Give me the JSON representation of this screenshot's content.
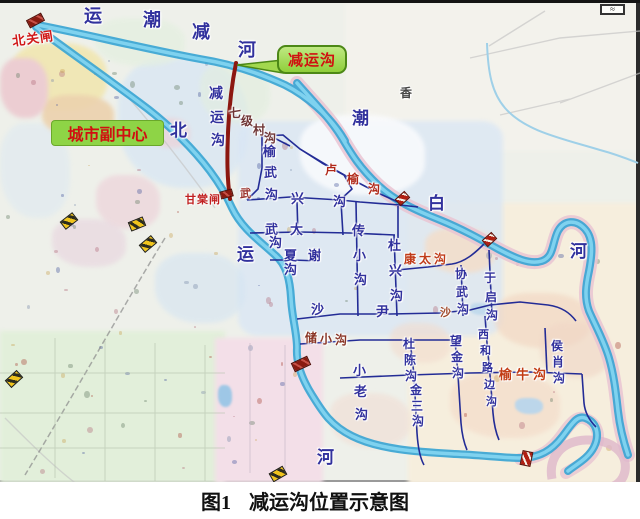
{
  "caption": {
    "figure": "图1",
    "title": "减运沟位置示意图"
  },
  "callout": {
    "text": "减运沟"
  },
  "city_subcenter": {
    "text": "城市副中心"
  },
  "colors": {
    "river_cyan": "#3ba6d4",
    "river_core": "#7fd2ef",
    "floodplain_pink": "#e9c4d2",
    "channel_dark_red": "#8c1710",
    "ditch_navy": "#232c96",
    "label_blue": "#31319d",
    "label_red": "#c03a18",
    "callout_green": "#8fce3a",
    "callout_text_red": "#d01010"
  },
  "map": {
    "stations": [
      {
        "name": "beiguanzha",
        "text": "北关闸",
        "x": 12,
        "y": 29,
        "size": 13,
        "color": "#d01818",
        "rot": -8
      },
      {
        "name": "gantangzha",
        "text": "甘棠闸",
        "x": 185,
        "y": 192,
        "size": 11,
        "color": "#c02020",
        "rot": 0
      }
    ],
    "labels": [
      {
        "name": "yunchaojian-river",
        "text": "运潮减河",
        "size": 18,
        "color": "#31319d",
        "chars": [
          {
            "c": "运",
            "x": 84,
            "y": 4
          },
          {
            "c": "潮",
            "x": 143,
            "y": 8
          },
          {
            "c": "减",
            "x": 192,
            "y": 20
          },
          {
            "c": "河",
            "x": 238,
            "y": 38
          }
        ]
      },
      {
        "name": "beiyun-river",
        "text": "北运河",
        "size": 17,
        "color": "#31319d",
        "chars": [
          {
            "c": "北",
            "x": 170,
            "y": 119
          },
          {
            "c": "运",
            "x": 237,
            "y": 243
          },
          {
            "c": "河",
            "x": 317,
            "y": 446
          }
        ]
      },
      {
        "name": "chaobai-river",
        "text": "潮白河",
        "size": 17,
        "color": "#31319d",
        "chars": [
          {
            "c": "潮",
            "x": 352,
            "y": 107
          },
          {
            "c": "白",
            "x": 428,
            "y": 192
          },
          {
            "c": "河",
            "x": 570,
            "y": 240
          }
        ]
      },
      {
        "name": "jianyungou-channel",
        "text": "减运沟",
        "size": 14,
        "color": "#31319d",
        "chars": [
          {
            "c": "减",
            "x": 209,
            "y": 85
          },
          {
            "c": "运",
            "x": 210,
            "y": 109
          },
          {
            "c": "沟",
            "x": 211,
            "y": 132
          }
        ]
      },
      {
        "name": "qijicungou",
        "text": "七级村沟",
        "size": 12,
        "color": "#6f3535",
        "chars": [
          {
            "c": "七",
            "x": 229,
            "y": 104
          },
          {
            "c": "级",
            "x": 241,
            "y": 112
          },
          {
            "c": "村",
            "x": 253,
            "y": 121
          },
          {
            "c": "沟",
            "x": 264,
            "y": 129
          }
        ]
      },
      {
        "name": "luyugou",
        "text": "卢榆沟",
        "size": 12,
        "color": "#b02818",
        "chars": [
          {
            "c": "卢",
            "x": 325,
            "y": 161
          },
          {
            "c": "榆",
            "x": 347,
            "y": 170
          },
          {
            "c": "沟",
            "x": 368,
            "y": 180
          }
        ]
      },
      {
        "name": "yuwugou",
        "text": "榆武沟",
        "size": 13,
        "color": "#31319d",
        "chars": [
          {
            "c": "榆",
            "x": 263,
            "y": 142
          },
          {
            "c": "武",
            "x": 264,
            "y": 163
          },
          {
            "c": "沟",
            "x": 265,
            "y": 185
          }
        ]
      },
      {
        "name": "xinggou",
        "text": "兴沟",
        "size": 13,
        "color": "#31319d",
        "chars": [
          {
            "c": "兴",
            "x": 291,
            "y": 189
          },
          {
            "c": "沟",
            "x": 333,
            "y": 192
          }
        ]
      },
      {
        "name": "wu-red-char",
        "text": "武",
        "size": 11,
        "color": "#99302a",
        "chars": [
          {
            "c": "武",
            "x": 240,
            "y": 186
          }
        ]
      },
      {
        "name": "wudagou",
        "text": "武大沟",
        "size": 13,
        "color": "#31319d",
        "chars": [
          {
            "c": "武",
            "x": 265,
            "y": 220
          },
          {
            "c": "大",
            "x": 290,
            "y": 220
          },
          {
            "c": "沟",
            "x": 269,
            "y": 233
          }
        ]
      },
      {
        "name": "xiaxiegou",
        "text": "夏谢沟",
        "size": 13,
        "color": "#31319d",
        "chars": [
          {
            "c": "夏",
            "x": 284,
            "y": 246
          },
          {
            "c": "谢",
            "x": 308,
            "y": 246
          },
          {
            "c": "沟",
            "x": 284,
            "y": 260
          }
        ]
      },
      {
        "name": "chuanxiaogou",
        "text": "传小沟",
        "size": 13,
        "color": "#31319d",
        "chars": [
          {
            "c": "传",
            "x": 352,
            "y": 221
          },
          {
            "c": "小",
            "x": 353,
            "y": 246
          },
          {
            "c": "沟",
            "x": 354,
            "y": 270
          }
        ]
      },
      {
        "name": "duxinggou",
        "text": "杜兴沟",
        "size": 13,
        "color": "#31319d",
        "chars": [
          {
            "c": "杜",
            "x": 388,
            "y": 236
          },
          {
            "c": "兴",
            "x": 389,
            "y": 261
          },
          {
            "c": "沟",
            "x": 390,
            "y": 286
          }
        ]
      },
      {
        "name": "kangtaigou",
        "text": "康太沟",
        "size": 12,
        "color": "#c03a18",
        "chars": [
          {
            "c": "康",
            "x": 404,
            "y": 250
          },
          {
            "c": "太",
            "x": 419,
            "y": 250
          },
          {
            "c": "沟",
            "x": 434,
            "y": 250
          }
        ]
      },
      {
        "name": "xiewugou",
        "text": "协武沟",
        "size": 12,
        "color": "#31319d",
        "chars": [
          {
            "c": "协",
            "x": 455,
            "y": 265
          },
          {
            "c": "武",
            "x": 456,
            "y": 283
          },
          {
            "c": "沟",
            "x": 457,
            "y": 300
          }
        ]
      },
      {
        "name": "yuqigou",
        "text": "于启沟",
        "size": 12,
        "color": "#31319d",
        "chars": [
          {
            "c": "于",
            "x": 484,
            "y": 269
          },
          {
            "c": "启",
            "x": 485,
            "y": 288
          },
          {
            "c": "沟",
            "x": 486,
            "y": 306
          }
        ]
      },
      {
        "name": "sha-char",
        "text": "沙",
        "size": 13,
        "color": "#31319d",
        "chars": [
          {
            "c": "沙",
            "x": 311,
            "y": 300
          }
        ]
      },
      {
        "name": "yin-char",
        "text": "尹",
        "size": 13,
        "color": "#31319d",
        "chars": [
          {
            "c": "尹",
            "x": 376,
            "y": 302
          }
        ]
      },
      {
        "name": "sha-red-char",
        "text": "沙",
        "size": 11,
        "color": "#a04828",
        "chars": [
          {
            "c": "沙",
            "x": 440,
            "y": 305
          }
        ]
      },
      {
        "name": "chuxiaogou",
        "text": "储小沟",
        "size": 12,
        "color": "#8a3526",
        "chars": [
          {
            "c": "储",
            "x": 305,
            "y": 329
          },
          {
            "c": "小",
            "x": 320,
            "y": 330
          },
          {
            "c": "沟",
            "x": 335,
            "y": 331
          }
        ]
      },
      {
        "name": "duchengou",
        "text": "杜陈沟",
        "size": 12,
        "color": "#31319d",
        "chars": [
          {
            "c": "杜",
            "x": 403,
            "y": 335
          },
          {
            "c": "陈",
            "x": 404,
            "y": 351
          },
          {
            "c": "沟",
            "x": 405,
            "y": 367
          }
        ]
      },
      {
        "name": "wangjingou",
        "text": "望金沟",
        "size": 12,
        "color": "#31319d",
        "chars": [
          {
            "c": "望",
            "x": 450,
            "y": 332
          },
          {
            "c": "金",
            "x": 451,
            "y": 348
          },
          {
            "c": "沟",
            "x": 452,
            "y": 364
          }
        ]
      },
      {
        "name": "xiheluibiangou",
        "text": "西和路边沟",
        "size": 11,
        "color": "#31319d",
        "chars": [
          {
            "c": "西",
            "x": 478,
            "y": 327
          },
          {
            "c": "和",
            "x": 480,
            "y": 343
          },
          {
            "c": "路",
            "x": 482,
            "y": 360
          },
          {
            "c": "边",
            "x": 484,
            "y": 377
          },
          {
            "c": "沟",
            "x": 486,
            "y": 394
          }
        ]
      },
      {
        "name": "yuniugou",
        "text": "榆牛沟",
        "size": 13,
        "color": "#c23c14",
        "chars": [
          {
            "c": "榆",
            "x": 499,
            "y": 365
          },
          {
            "c": "牛",
            "x": 516,
            "y": 365
          },
          {
            "c": "沟",
            "x": 533,
            "y": 365
          }
        ]
      },
      {
        "name": "houxiaogou",
        "text": "侯肖沟",
        "size": 12,
        "color": "#31319d",
        "chars": [
          {
            "c": "侯",
            "x": 551,
            "y": 337
          },
          {
            "c": "肖",
            "x": 552,
            "y": 353
          },
          {
            "c": "沟",
            "x": 553,
            "y": 369
          }
        ]
      },
      {
        "name": "xiaolaogou",
        "text": "小老沟",
        "size": 13,
        "color": "#31319d",
        "chars": [
          {
            "c": "小",
            "x": 353,
            "y": 361
          },
          {
            "c": "老",
            "x": 354,
            "y": 382
          },
          {
            "c": "沟",
            "x": 355,
            "y": 405
          }
        ]
      },
      {
        "name": "jinsangou",
        "text": "金三沟",
        "size": 12,
        "color": "#31319d",
        "chars": [
          {
            "c": "金",
            "x": 410,
            "y": 381
          },
          {
            "c": "三",
            "x": 411,
            "y": 397
          },
          {
            "c": "沟",
            "x": 412,
            "y": 412
          }
        ]
      },
      {
        "name": "xiang-char",
        "text": "香",
        "size": 12,
        "color": "#454545",
        "chars": [
          {
            "c": "香",
            "x": 400,
            "y": 84
          }
        ]
      }
    ],
    "gates": [
      {
        "name": "gate-yellow-1",
        "type": "yellow",
        "x": 61,
        "y": 213,
        "w": 16,
        "h": 10,
        "rot": -38
      },
      {
        "name": "gate-yellow-2",
        "type": "yellow",
        "x": 129,
        "y": 216,
        "w": 16,
        "h": 10,
        "rot": -22
      },
      {
        "name": "gate-yellow-3",
        "type": "yellow",
        "x": 140,
        "y": 236,
        "w": 16,
        "h": 10,
        "rot": -40
      },
      {
        "name": "gate-yellow-4",
        "type": "yellow",
        "x": 6,
        "y": 371,
        "w": 16,
        "h": 10,
        "rot": -42
      },
      {
        "name": "gate-yellow-5",
        "type": "yellow",
        "x": 270,
        "y": 466,
        "w": 16,
        "h": 10,
        "rot": -30
      },
      {
        "name": "gate-redwhite-1",
        "type": "redwhite",
        "x": 396,
        "y": 191,
        "w": 13,
        "h": 9,
        "rot": -42
      },
      {
        "name": "gate-redwhite-2",
        "type": "redwhite",
        "x": 483,
        "y": 232,
        "w": 13,
        "h": 9,
        "rot": -42
      },
      {
        "name": "gate-redwhite-3",
        "type": "redwhite",
        "x": 521,
        "y": 448,
        "w": 11,
        "h": 15,
        "rot": 12
      },
      {
        "name": "marker-beiguan",
        "type": "darkred",
        "x": 27,
        "y": 13,
        "w": 17,
        "h": 9,
        "rot": -28
      },
      {
        "name": "marker-gantang",
        "type": "darkred",
        "x": 220,
        "y": 187,
        "w": 13,
        "h": 8,
        "rot": -15
      },
      {
        "name": "marker-rucun",
        "type": "darkred",
        "x": 292,
        "y": 356,
        "w": 18,
        "h": 10,
        "rot": -25
      }
    ],
    "corner_icon": {
      "glyph": "≈"
    }
  }
}
